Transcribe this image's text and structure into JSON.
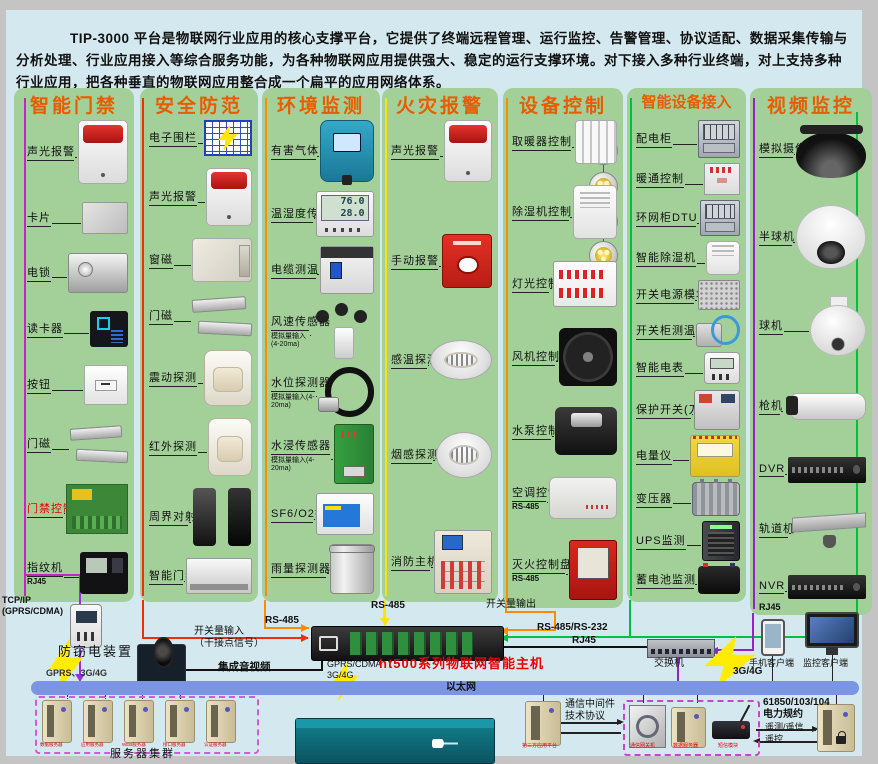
{
  "intro": "TIP-3000 平台是物联网行业应用的核心支撑平台，它提供了终端远程管理、运行监控、告警管理、协议适配、数据采集传输与分析处理、行业应用接入等综合服务功能，为各种物联网应用提供强大、稳定的运行支撑环境。对下接入多种行业终端，对上支持多种行业应用，把各种垂直的物联网应用整合成一个扁平的应用网络体系。",
  "columns": [
    {
      "id": "access-control",
      "title": "智能门禁",
      "bus": "#cc20cc",
      "items": [
        {
          "name": "sound-light-alarm",
          "label": "声光报警",
          "dev": {
            "s": "alarm",
            "w": 48,
            "h": 62
          }
        },
        {
          "name": "id-card",
          "label": "卡片",
          "dev": {
            "s": "card",
            "w": 44,
            "h": 30
          }
        },
        {
          "name": "electric-lock",
          "label": "电锁",
          "dev": {
            "s": "metal",
            "w": 58,
            "h": 38
          }
        },
        {
          "name": "card-reader",
          "label": "读卡器",
          "dev": {
            "s": "dark",
            "w": 38,
            "h": 36
          }
        },
        {
          "name": "exit-button",
          "label": "按钮",
          "dev": {
            "s": "plate",
            "w": 42,
            "h": 38
          }
        },
        {
          "name": "door-magnet",
          "label": "门磁",
          "dev": {
            "s": "bars",
            "w": 58,
            "h": 42
          }
        },
        {
          "name": "access-controller",
          "label": "门禁控制器",
          "red": true,
          "dev": {
            "s": "pcb",
            "w": 60,
            "h": 48
          }
        },
        {
          "name": "fingerprint-terminal",
          "label": "指纹机",
          "sub": "RJ45",
          "dev": {
            "s": "fp",
            "w": 48,
            "h": 42
          }
        }
      ]
    },
    {
      "id": "security",
      "title": "安全防范",
      "bus": "#f03000",
      "items": [
        {
          "name": "electronic-fence",
          "label": "电子围栏",
          "dev": {
            "s": "fence",
            "w": 44,
            "h": 32
          }
        },
        {
          "name": "sound-light-alarm",
          "label": "声光报警",
          "dev": {
            "s": "alarm",
            "w": 44,
            "h": 56
          }
        },
        {
          "name": "window-magnet",
          "label": "窗磁",
          "dev": {
            "s": "winmag",
            "w": 58,
            "h": 42
          }
        },
        {
          "name": "door-magnet",
          "label": "门磁",
          "dev": {
            "s": "bars",
            "w": 60,
            "h": 44
          }
        },
        {
          "name": "vibration-detector",
          "label": "震动探测",
          "dev": {
            "s": "pir",
            "w": 46,
            "h": 54
          }
        },
        {
          "name": "infrared-detector",
          "label": "红外探测",
          "dev": {
            "s": "pir",
            "w": 42,
            "h": 56
          }
        },
        {
          "name": "perimeter-beam",
          "label": "周界对射",
          "dev": {
            "s": "towers",
            "w": 60,
            "h": 58
          }
        },
        {
          "name": "smart-access",
          "label": "智能门禁",
          "dev": {
            "s": "flat",
            "w": 64,
            "h": 34
          }
        }
      ]
    },
    {
      "id": "environment",
      "title": "环境监测",
      "bus": "#ff8c00",
      "items": [
        {
          "name": "harmful-gas-detector",
          "label": "有害气体",
          "dev": {
            "s": "gas",
            "w": 52,
            "h": 60
          }
        },
        {
          "name": "temp-humidity-sensor",
          "label": "温湿度传感器",
          "screen": "76.0\n28.0",
          "dev": {
            "s": "lcd",
            "w": 56,
            "h": 44
          }
        },
        {
          "name": "cable-temperature",
          "label": "电缆测温",
          "dev": {
            "s": "breaker",
            "w": 52,
            "h": 46
          }
        },
        {
          "name": "wind-speed-sensor",
          "label": "风速传感器",
          "sub": "模拟量输入(4-20ma)",
          "dev": {
            "s": "wind",
            "w": 62,
            "h": 56
          }
        },
        {
          "name": "water-level-detector",
          "label": "水位探测器",
          "sub": "模拟量输入(4-20ma)",
          "dev": {
            "s": "probe",
            "w": 56,
            "h": 48
          }
        },
        {
          "name": "water-immersion-sensor",
          "label": "水浸传感器",
          "sub": "模拟量输入(4-20ma)",
          "dev": {
            "s": "dingreen",
            "w": 38,
            "h": 58
          }
        },
        {
          "name": "sf6-o2-detector",
          "label": "SF6/O2探测器",
          "dev": {
            "s": "wallbox2",
            "w": 56,
            "h": 40
          }
        },
        {
          "name": "rainfall-detector",
          "label": "雨量探测器",
          "dev": {
            "s": "bucket",
            "w": 42,
            "h": 48
          }
        }
      ]
    },
    {
      "id": "fire-alarm",
      "title": "火灾报警",
      "bus": "#ffe400",
      "items": [
        {
          "name": "sound-light-alarm",
          "label": "声光报警",
          "dev": {
            "s": "alarm",
            "w": 46,
            "h": 60
          }
        },
        {
          "name": "manual-alarm",
          "label": "手动报警",
          "dev": {
            "s": "callpoint",
            "w": 48,
            "h": 52
          }
        },
        {
          "name": "heat-detector",
          "label": "感温探测",
          "dev": {
            "s": "smoke",
            "w": 60,
            "h": 38
          }
        },
        {
          "name": "smoke-detector",
          "label": "烟感探测",
          "dev": {
            "s": "smoke",
            "w": 54,
            "h": 44
          }
        },
        {
          "name": "fire-host",
          "label": "消防主机",
          "dev": {
            "s": "firepanel",
            "w": 56,
            "h": 62
          }
        }
      ]
    },
    {
      "id": "device-control",
      "title": "设备控制",
      "bus": "#ff8c00",
      "items": [
        {
          "name": "heater-control",
          "label": "取暖器控制",
          "dev": {
            "s": "radiator",
            "w": 40,
            "h": 42
          }
        },
        {
          "name": "dehumidifier-control",
          "label": "除湿机控制",
          "dev": {
            "s": "dehum",
            "w": 42,
            "h": 52
          }
        },
        {
          "name": "lighting-control",
          "label": "灯光控制",
          "dev": {
            "s": "relay",
            "w": 62,
            "h": 44
          }
        },
        {
          "name": "fan-control",
          "label": "风机控制",
          "dev": {
            "s": "fan",
            "w": 58,
            "h": 58
          }
        },
        {
          "name": "pump-control",
          "label": "水泵控制",
          "dev": {
            "s": "pump",
            "w": 62,
            "h": 48
          }
        },
        {
          "name": "ac-control",
          "label": "空调控制",
          "sub": "RS-485",
          "dev": {
            "s": "acbox",
            "w": 66,
            "h": 40
          }
        },
        {
          "name": "fire-extinguish-panel",
          "label": "灭火控制盘",
          "sub": "RS-485",
          "dev": {
            "s": "redcab",
            "w": 46,
            "h": 58
          }
        }
      ]
    },
    {
      "id": "smart-device-access",
      "title": "智能设备接入",
      "bus": "#00c040",
      "items": [
        {
          "name": "power-cabinet",
          "label": "配电柜",
          "dev": {
            "s": "cab",
            "w": 40,
            "h": 36
          }
        },
        {
          "name": "hvac-control",
          "label": "暖通控制",
          "dev": {
            "s": "wallbox",
            "w": 34,
            "h": 30
          }
        },
        {
          "name": "ring-cabinet-dtu",
          "label": "环网柜DTU",
          "dev": {
            "s": "cab",
            "w": 38,
            "h": 34
          }
        },
        {
          "name": "smart-dehumidifier",
          "label": "智能除湿机",
          "dev": {
            "s": "dehum",
            "w": 32,
            "h": 32
          }
        },
        {
          "name": "switching-power-module",
          "label": "开关电源模块",
          "dev": {
            "s": "psu",
            "w": 40,
            "h": 28
          }
        },
        {
          "name": "switchgear-temp",
          "label": "开关柜测温",
          "dev": {
            "s": "cablesensor",
            "w": 44,
            "h": 32
          }
        },
        {
          "name": "smart-meter",
          "label": "智能电表",
          "dev": {
            "s": "meter2",
            "w": 34,
            "h": 30
          }
        },
        {
          "name": "protection-switch",
          "label": "保护开关(刀闸)",
          "dev": {
            "s": "dingray",
            "w": 44,
            "h": 38
          }
        },
        {
          "name": "power-meter",
          "label": "电量仪",
          "dev": {
            "s": "dinyellow",
            "w": 48,
            "h": 40
          }
        },
        {
          "name": "transformer",
          "label": "变压器",
          "dev": {
            "s": "transformer",
            "w": 46,
            "h": 32
          }
        },
        {
          "name": "ups-monitor",
          "label": "UPS监测",
          "dev": {
            "s": "ups",
            "w": 36,
            "h": 38
          }
        },
        {
          "name": "battery-monitor",
          "label": "蓄电池监测",
          "dev": {
            "s": "battery",
            "w": 42,
            "h": 28
          }
        }
      ]
    },
    {
      "id": "video-surveillance",
      "title": "视频监控",
      "bus": "#9820c8",
      "footer": "RJ45",
      "items": [
        {
          "name": "analog-camera",
          "label": "模拟摄像机",
          "dev": {
            "s": "domeblack",
            "w": 70,
            "h": 58
          }
        },
        {
          "name": "dome-camera",
          "label": "半球机",
          "dev": {
            "s": "domewhite",
            "w": 68,
            "h": 62
          }
        },
        {
          "name": "speed-dome",
          "label": "球机",
          "dev": {
            "s": "ptz",
            "w": 56,
            "h": 60
          }
        },
        {
          "name": "bullet-camera",
          "label": "枪机",
          "dev": {
            "s": "bullet",
            "w": 82,
            "h": 46
          }
        },
        {
          "name": "dvr",
          "label": "DVR",
          "dev": {
            "s": "rack",
            "w": 78,
            "h": 26
          }
        },
        {
          "name": "rail-camera",
          "label": "轨道机",
          "dev": {
            "s": "rail",
            "w": 74,
            "h": 38
          }
        },
        {
          "name": "nvr",
          "label": "NVR",
          "dev": {
            "s": "rack",
            "w": 78,
            "h": 24
          }
        }
      ]
    }
  ],
  "labels": {
    "tcpip": "TCP/IP\n(GPRS/CDMA)",
    "anti_theft": "防窃电装置",
    "gprs_left": "GPRS、3G/4G",
    "di_input": "开关量输入\n（干接点信号）",
    "rs485_col3": "RS-485",
    "rs485_col4": "RS-485",
    "do_output": "开关量输出",
    "rs485_232": "RS-485/RS-232",
    "rj45_mid": "RJ45",
    "av": "集成音视频",
    "host_conn": "GPRS/CDMA\n3G/4G",
    "host_name": "ht500系列物联网智能主机",
    "switch": "交换机",
    "phone": "手机客户端",
    "monitor": "监控客户端",
    "g3g4": "3G/4G",
    "ethernet": "以太网",
    "cluster": "服务器集群",
    "middleware": "通信中间件\n技术协议",
    "third_party": "第三方应用平台",
    "gateway": "通信网关机",
    "comm_server": "数据服务器",
    "sms": "短信模块",
    "power_protocol": "61850/103/104\n电力规约",
    "telemetry": "遥测/遥信",
    "telecontrol": "遥控"
  },
  "cluster_servers": [
    "数据服务器",
    "应用服务器",
    "WEB服务器",
    "接口服务器",
    "认证服务器"
  ],
  "colors": {
    "accent_title": "#e85c00",
    "panel_green": "#a3d099",
    "background": "#d4e9ef",
    "ethernet_bar": "#7b95e4",
    "highlight_red": "#e60000"
  }
}
